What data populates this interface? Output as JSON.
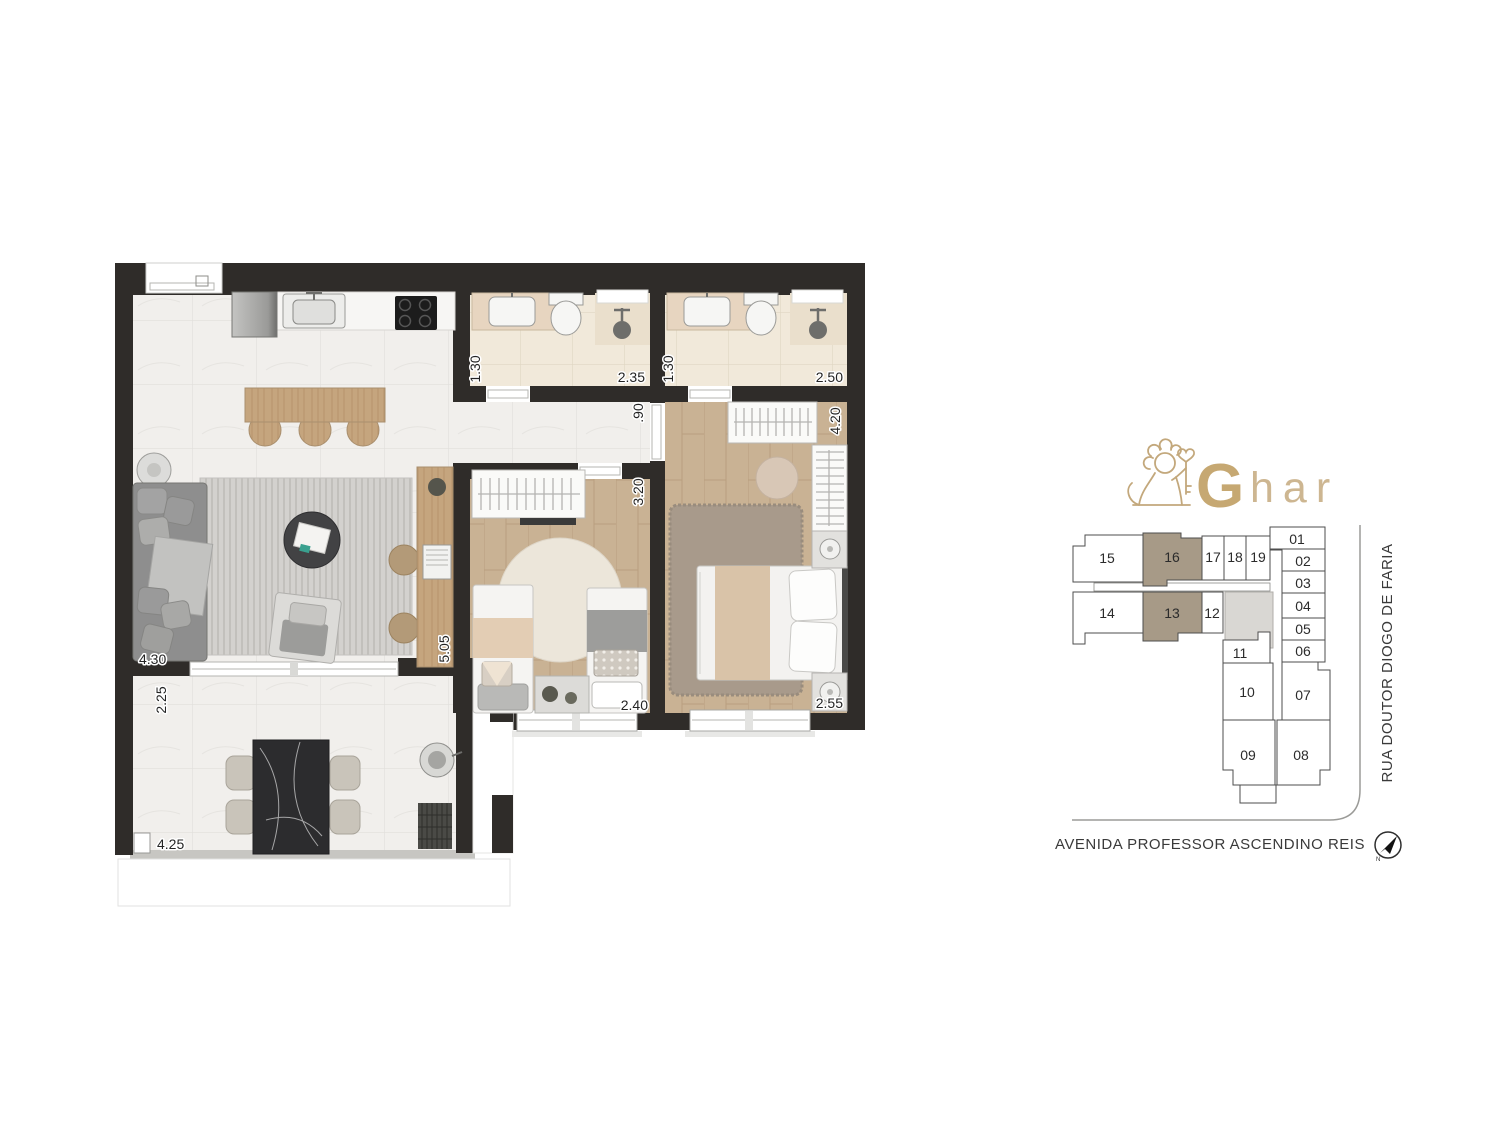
{
  "page": {
    "title": "Apartment floor plan with building key plan"
  },
  "branding": {
    "logo_g": "G",
    "logo_rest": "har",
    "gold": "#c3a87c"
  },
  "plan": {
    "dims": {
      "bath1_width": "1.30",
      "bath1_length": "2.35",
      "bath2_width": "1.30",
      "bath2_length": "2.50",
      "hall_width": ".90",
      "bedroom2_length": "3.20",
      "bedroom2_width": "2.40",
      "bedroom1_length": "4.20",
      "bedroom1_width": "2.55",
      "living_width": "4.30",
      "living_length": "5.05",
      "terrace_depth": "2.25",
      "terrace_width": "4.25"
    }
  },
  "keyplan": {
    "units": [
      {
        "label": "01"
      },
      {
        "label": "02"
      },
      {
        "label": "03"
      },
      {
        "label": "04"
      },
      {
        "label": "05"
      },
      {
        "label": "06"
      },
      {
        "label": "07"
      },
      {
        "label": "08"
      },
      {
        "label": "09"
      },
      {
        "label": "10"
      },
      {
        "label": "11"
      },
      {
        "label": "12"
      },
      {
        "label": "13",
        "highlighted": true
      },
      {
        "label": "14"
      },
      {
        "label": "15"
      },
      {
        "label": "16",
        "highlighted": true
      },
      {
        "label": "17"
      },
      {
        "label": "18"
      },
      {
        "label": "19"
      }
    ],
    "highlight_color": "#a79a87",
    "avenue_label": "AVENIDA PROFESSOR ASCENDINO REIS",
    "street_label": "RUA DOUTOR DIOGO DE FARIA",
    "compass_label": "N"
  }
}
